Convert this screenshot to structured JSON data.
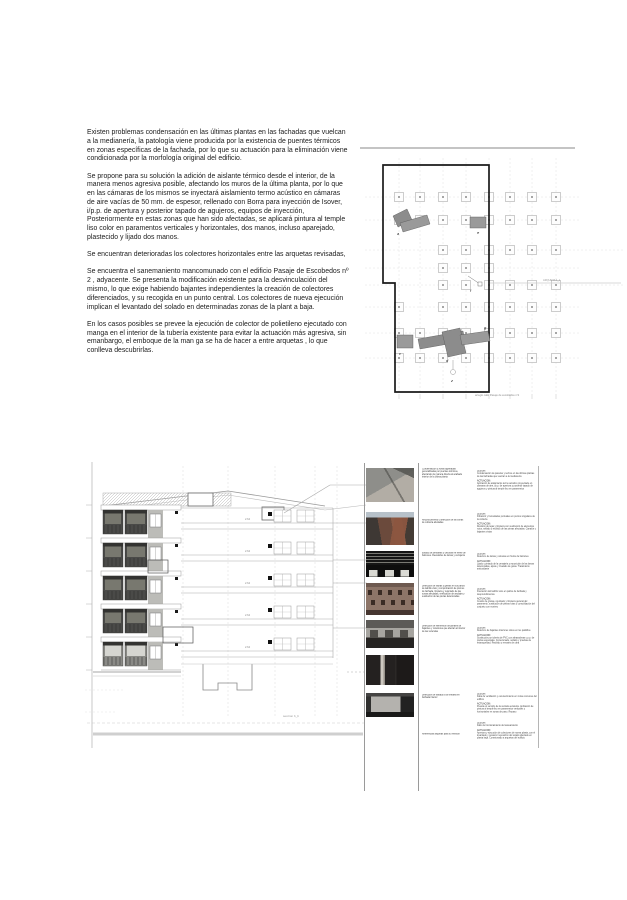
{
  "document": {
    "paragraphs": [
      "Existen problemas condensación en las últimas plantas en las fachadas que vuelcan a la medianería, la patología viene producida por la existencia de puentes térmicos en zonas específicas de la fachada, por lo que su actuación para la eliminación viene condicionada por la morfología original del edificio.",
      "Se propone para su solución la adición de aislante térmico desde el interior, de la manera menos agresiva posible, afectando los muros de la última planta, por lo que en las cámaras de los mismos se inyectará aislamiento termo acústico en cámaras de aire vacías de 50 mm. de espesor, rellenado con Borra para inyección de Isover, i/p.p. de apertura y posterior tapado de agujeros, equipos de inyección, Posteriormente en estas zonas que han sido afectadas, se aplicará pintura al temple liso color en paramentos verticales y horizontales, dos manos, incluso aparejado, plastecido y lijado dos manos.",
      "Se encuentran deterioradas los colectores horizontales entre las arquetas revisadas,",
      "Se encuentra el sanemaniento mancomunado con el edificio Pasaje de Escobedos nº 2 , adyacente. Se presenta la modificación existente para la desvinculación del mismo, lo que exige habiendo bajantes independientes la creación de colectores diferenciados, y su recogida en un punto central. Los colectores de nueva ejecución implican el levantado del solado en determinadas zonas de la plant a baja.",
      "En los casos posibles se prevee la ejecución de colector de polietileno ejecutado con manga en el interior de la tubería existente para evitar la actuación más agresiva, sin emanbargo, el emboque de la man ga se ha de hacer a entre arquetas , lo que conlleva descubrirlas."
    ]
  },
  "plan": {
    "caption": "arreglo calle Pasaje de escobedos  nº2",
    "leader_label": "ARQUETA 1_1",
    "markers": [
      "a",
      "e",
      "f",
      "c",
      "d",
      "g",
      "z"
    ]
  },
  "elevation": {
    "section_label": "seccion b_b",
    "dims": [
      "2.64",
      "2.64",
      "2.64",
      "2.64",
      "2.64"
    ]
  },
  "photos": [
    {
      "name": "interior-ceiling-damage"
    },
    {
      "name": "aerial-roof-view"
    },
    {
      "name": "balcony-louvre-strip"
    },
    {
      "name": "brick-facade"
    },
    {
      "name": "interior-room-wall"
    },
    {
      "name": "dark-interior-doorway"
    },
    {
      "name": "interior-garage-wall"
    }
  ],
  "annotations": {
    "left": [
      "Condensación y zonas agrietadas generalizadas por puentes térmicos, afectando de manera directa al acabado interior de la última planta",
      "Reconocimiento y detección de las zonas de cubierta afectadas",
      "Estado de persianas y celosías en frente de balcones. Revestidos de lamas y cerrajería",
      "Detección de fisuras y grietas en los paños de ladrillo visto y comprobación de plomos de fachada, limpieza y rejuntado de las zonas afectadas, verificación de anclajes y sustitución de las piezas deterioradas",
      "Detección de elementos funcionales de bajantes y colectores que afectan al interior de las viviendas",
      "Detección de traslado a la ventana en fachada interior",
      "Referencias arquetas para su revisión"
    ],
    "right": [
      {
        "lesion_label": "LESION:",
        "lesion": "Condensación de paredes y techos en las últimas plantas de las fachadas que vuelcan a la medianería",
        "actuacion_label": "ACTUACION:",
        "actuacion": "Aplicación de aislamiento termo acústico proyectado en cámaras de aire, i/p.p. de apertura y posterior tapado de agujeros y pintura al temple liso en paramentos"
      },
      {
        "lesion_label": "LESION:",
        "lesion": "Filtración y humedades puntuales en puntos singulares de la cubierta",
        "actuacion_label": "ACTUACION:",
        "actuacion": "Revisión de tejas y limpieza con sustitución de elementos rotos, sellado y recibido de las piezas afectadas. Canalón y bajantes vistas"
      },
      {
        "lesion_label": "LESION:",
        "lesion": "Deterioro de lamas y celosías en frente de balcones",
        "actuacion_label": "ACTUACION:",
        "actuacion": "Lijado y pintado de la cerrajería y reposición de las lamas deterioradas, ajuste y nivelado de guías. Tratamiento antioxidante"
      },
      {
        "lesion_label": "LESION:",
        "lesion": "Fisuración del ladrillo visto en paños de fachada y desprendimientos",
        "actuacion_label": "ACTUACION:",
        "actuacion": "Cosido de grietas, rejuntado y limpieza general del paramento, sustitución de piezas rotas y consolidación del conjunto con mortero"
      },
      {
        "lesion_label": "LESION:",
        "lesion": "Deterioro de bajantes interiores vistos en los patinillos",
        "actuacion_label": "ACTUACION:",
        "actuacion": "Sustitución por tubería de PVC con abrazaderas y p.p. de piezas especiales. Conexionado, sellado y pruebas de estanqueidad. Recibido y remates de obra"
      },
      {
        "lesion_label": "LESION:",
        "lesion": "Falta de ventilación y oscurecimiento en zonas comunes del edificio",
        "actuacion_label": "ACTUACION:",
        "actuacion": "Puesta en servicio de la ventana existente. Aplicación de pintura al temple liso en paramentos verticales y horizontales en zonas de paso. Repaso"
      },
      {
        "lesion_label": "LESION:",
        "lesion": "Fallo de funcionamiento del saneamiento",
        "actuacion_label": "ACTUACION:",
        "actuacion": "Apertura y ejecución de colectores de nueva planta, con el levantado y posterior reposición del solado afectado en planta baja. Conexionado a arquetas del edificio"
      }
    ]
  },
  "colors": {
    "plan_highlight": "#8c8c8c",
    "plan_line": "#b8b8b8",
    "boundary": "#1a1a1a",
    "facade_dark": "#4a4a48",
    "facade_panel": "#bcbcb8"
  }
}
